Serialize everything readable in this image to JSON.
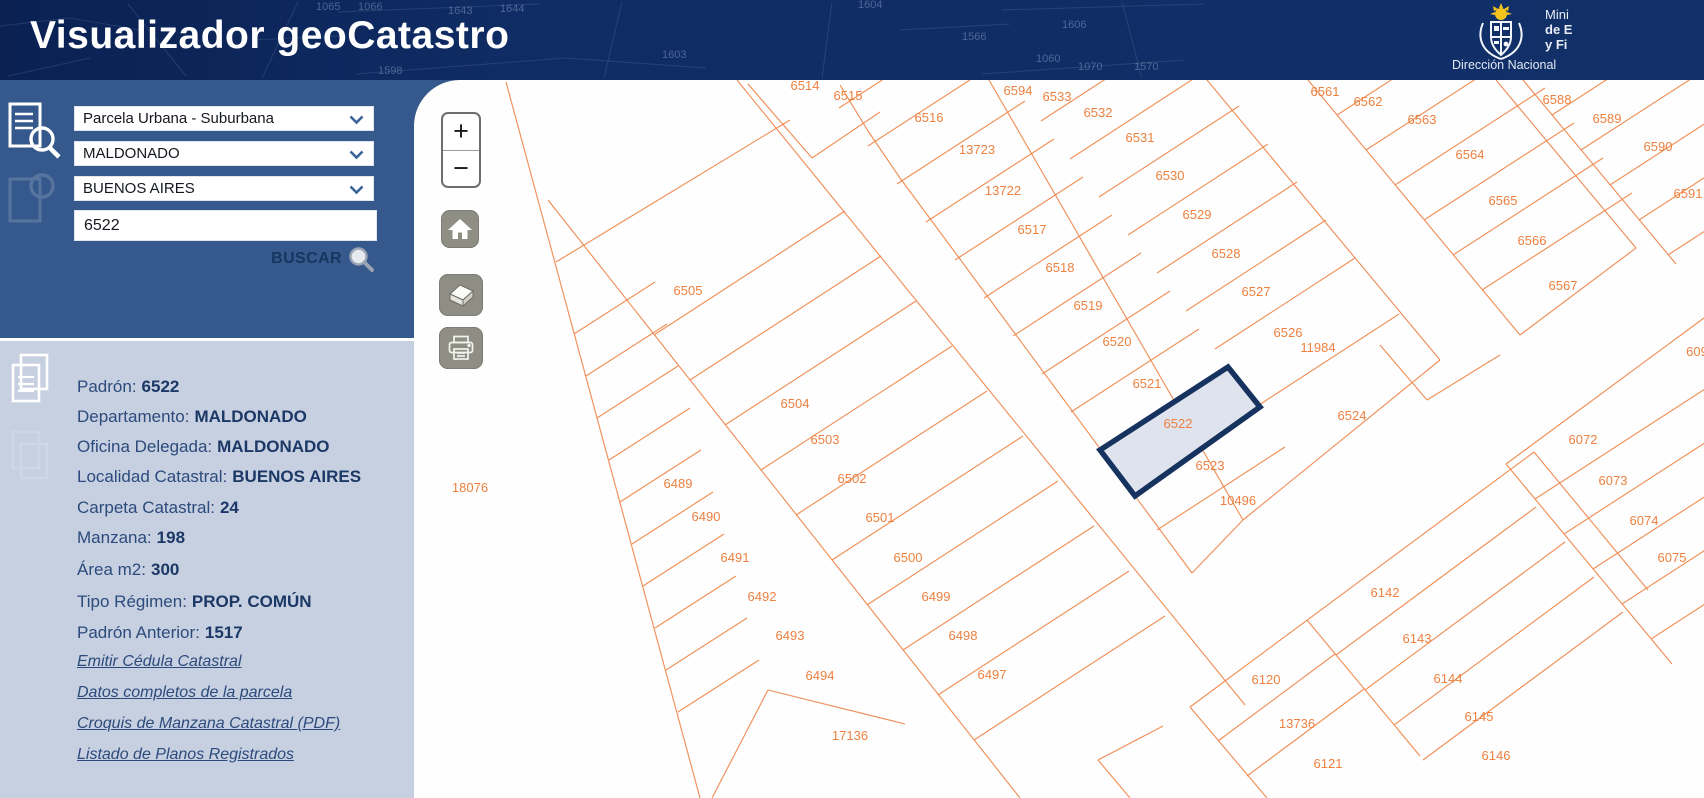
{
  "colors": {
    "header_bg": "#0f2c64",
    "search_panel_bg": "#35598c",
    "info_panel_bg": "#c6d0e0",
    "map_line": "#ef8a50",
    "map_label": "#ed8140",
    "selected_stroke": "#16335f",
    "selected_fill": "#dfe3ee",
    "link_color": "#2c4a7c"
  },
  "header": {
    "title": "Visualizador geoCatastro",
    "org_line1": "Mini",
    "org_line2": "de E",
    "org_line3": "y Fi",
    "org_sub": "Dirección Nacional",
    "sketch": {
      "segments": [
        [
          0,
          26,
          70,
          18
        ],
        [
          70,
          18,
          140,
          30
        ],
        [
          8,
          76,
          90,
          58
        ],
        [
          128,
          4,
          186,
          76
        ],
        [
          298,
          2,
          262,
          78
        ],
        [
          338,
          12,
          540,
          4
        ],
        [
          356,
          74,
          566,
          58
        ],
        [
          566,
          58,
          706,
          68
        ],
        [
          622,
          2,
          604,
          78
        ],
        [
          832,
          2,
          822,
          78
        ],
        [
          1002,
          10,
          1204,
          4
        ],
        [
          982,
          74,
          1184,
          60
        ],
        [
          1122,
          2,
          1142,
          78
        ],
        [
          250,
          40,
          340,
          36
        ],
        [
          900,
          30,
          1010,
          24
        ]
      ],
      "numbers": [
        [
          "1643",
          448,
          14
        ],
        [
          "1644",
          500,
          12
        ],
        [
          "1598",
          378,
          74
        ],
        [
          "1603",
          662,
          58
        ],
        [
          "1604",
          858,
          8
        ],
        [
          "1606",
          1062,
          28
        ],
        [
          "1060",
          1036,
          62
        ],
        [
          "1070",
          1078,
          70
        ],
        [
          "1570",
          1134,
          70
        ],
        [
          "1065",
          316,
          10
        ],
        [
          "1066",
          358,
          10
        ],
        [
          "1566",
          962,
          40
        ]
      ]
    }
  },
  "search_panel": {
    "selects": [
      {
        "value": "Parcela Urbana - Suburbana"
      },
      {
        "value": "MALDONADO"
      },
      {
        "value": "BUENOS AIRES"
      }
    ],
    "input_value": "6522",
    "button_label": "BUSCAR"
  },
  "info_panel": {
    "fields": [
      {
        "label": "Padrón:",
        "value": "6522"
      },
      {
        "label": "Departamento:",
        "value": "MALDONADO"
      },
      {
        "label": "Oficina Delegada:",
        "value": "MALDONADO"
      },
      {
        "label": "Localidad Catastral:",
        "value": "BUENOS AIRES"
      },
      {
        "label": "Carpeta Catastral:",
        "value": "24"
      },
      {
        "label": "Manzana:",
        "value": "198"
      },
      {
        "label": "Área m2:",
        "value": "300"
      },
      {
        "label": "Tipo Régimen:",
        "value": "PROP. COMÚN"
      },
      {
        "label": "Padrón Anterior:",
        "value": "1517"
      }
    ],
    "links": [
      "Emitir Cédula Catastral",
      "Datos completos de la parcela",
      "Croquis de Manzana Catastral (PDF)",
      "Listado de Planos Registrados"
    ]
  },
  "map": {
    "origin": [
      414,
      80
    ],
    "controls": {
      "zoom_in_label": "+",
      "zoom_out_label": "−"
    },
    "selected_parcel": {
      "id": "6522",
      "label_pos": [
        1178,
        428
      ],
      "points": [
        [
          1100,
          450
        ],
        [
          1228,
          367
        ],
        [
          1260,
          407
        ],
        [
          1135,
          496
        ]
      ]
    },
    "labels": [
      [
        "18076",
        470,
        492
      ],
      [
        "17136",
        850,
        740
      ],
      [
        "6514",
        805,
        90
      ],
      [
        "6515",
        848,
        100
      ],
      [
        "6516",
        929,
        122
      ],
      [
        "13723",
        977,
        154
      ],
      [
        "13722",
        1003,
        195
      ],
      [
        "6517",
        1032,
        234
      ],
      [
        "6518",
        1060,
        272
      ],
      [
        "6519",
        1088,
        310
      ],
      [
        "6520",
        1117,
        346
      ],
      [
        "6521",
        1147,
        388
      ],
      [
        "6523",
        1210,
        470
      ],
      [
        "10496",
        1238,
        505
      ],
      [
        "6594",
        1018,
        95
      ],
      [
        "6533",
        1057,
        101
      ],
      [
        "6532",
        1098,
        117
      ],
      [
        "6531",
        1140,
        142
      ],
      [
        "6530",
        1170,
        180
      ],
      [
        "6529",
        1197,
        219
      ],
      [
        "6528",
        1226,
        258
      ],
      [
        "6527",
        1256,
        296
      ],
      [
        "6526",
        1288,
        337
      ],
      [
        "11984",
        1318,
        352
      ],
      [
        "6524",
        1352,
        420
      ],
      [
        "6505",
        688,
        295
      ],
      [
        "6504",
        795,
        408
      ],
      [
        "6503",
        825,
        444
      ],
      [
        "6502",
        852,
        483
      ],
      [
        "6501",
        880,
        522
      ],
      [
        "6500",
        908,
        562
      ],
      [
        "6499",
        936,
        601
      ],
      [
        "6498",
        963,
        640
      ],
      [
        "6497",
        992,
        679
      ],
      [
        "6489",
        678,
        488
      ],
      [
        "6490",
        706,
        521
      ],
      [
        "6491",
        735,
        562
      ],
      [
        "6492",
        762,
        601
      ],
      [
        "6493",
        790,
        640
      ],
      [
        "6494",
        820,
        680
      ],
      [
        "6561",
        1325,
        96
      ],
      [
        "6562",
        1368,
        106
      ],
      [
        "6563",
        1422,
        124
      ],
      [
        "6564",
        1470,
        159
      ],
      [
        "6565",
        1503,
        205
      ],
      [
        "6566",
        1532,
        245
      ],
      [
        "6567",
        1563,
        290
      ],
      [
        "6588",
        1557,
        104
      ],
      [
        "6589",
        1607,
        123
      ],
      [
        "6590",
        1658,
        151
      ],
      [
        "6591",
        1688,
        198
      ],
      [
        "609",
        1697,
        356
      ],
      [
        "6072",
        1583,
        444
      ],
      [
        "6073",
        1613,
        485
      ],
      [
        "6074",
        1644,
        525
      ],
      [
        "6075",
        1672,
        562
      ],
      [
        "6142",
        1385,
        597
      ],
      [
        "6143",
        1417,
        643
      ],
      [
        "6144",
        1448,
        683
      ],
      [
        "6145",
        1479,
        721
      ],
      [
        "6146",
        1496,
        760
      ],
      [
        "6120",
        1266,
        684
      ],
      [
        "13736",
        1297,
        728
      ],
      [
        "6121",
        1328,
        768
      ]
    ],
    "segments": [
      [
        506,
        82,
        700,
        798
      ],
      [
        712,
        798,
        768,
        690
      ],
      [
        768,
        690,
        905,
        724
      ],
      [
        556,
        262,
        790,
        120
      ],
      [
        737,
        80,
        1245,
        705
      ],
      [
        548,
        200,
        1020,
        798
      ],
      [
        654,
        335,
        845,
        211
      ],
      [
        690,
        380,
        881,
        256
      ],
      [
        725,
        425,
        916,
        301
      ],
      [
        761,
        470,
        952,
        346
      ],
      [
        796,
        515,
        987,
        391
      ],
      [
        832,
        560,
        1023,
        436
      ],
      [
        867,
        605,
        1058,
        481
      ],
      [
        903,
        650,
        1094,
        526
      ],
      [
        938,
        695,
        1129,
        571
      ],
      [
        974,
        740,
        1165,
        616
      ],
      [
        574,
        334,
        655,
        282
      ],
      [
        586,
        376,
        667,
        324
      ],
      [
        597,
        418,
        678,
        366
      ],
      [
        609,
        460,
        690,
        408
      ],
      [
        620,
        502,
        701,
        450
      ],
      [
        632,
        544,
        713,
        492
      ],
      [
        643,
        586,
        724,
        534
      ],
      [
        655,
        628,
        736,
        576
      ],
      [
        666,
        670,
        747,
        618
      ],
      [
        678,
        712,
        759,
        660
      ],
      [
        748,
        84,
        812,
        158
      ],
      [
        812,
        158,
        880,
        112
      ],
      [
        840,
        85,
        868,
        131
      ],
      [
        868,
        131,
        900,
        178
      ],
      [
        900,
        178,
        1192,
        573
      ],
      [
        989,
        80,
        1243,
        520
      ],
      [
        1207,
        80,
        1440,
        360
      ],
      [
        1192,
        573,
        1243,
        520
      ],
      [
        1243,
        520,
        1440,
        360
      ],
      [
        1071,
        412,
        1199,
        329
      ],
      [
        1042,
        374,
        1170,
        291
      ],
      [
        1013,
        336,
        1141,
        253
      ],
      [
        984,
        298,
        1112,
        215
      ],
      [
        955,
        260,
        1083,
        177
      ],
      [
        926,
        222,
        1054,
        139
      ],
      [
        897,
        184,
        1025,
        101
      ],
      [
        868,
        146,
        996,
        63
      ],
      [
        839,
        108,
        967,
        25
      ],
      [
        1157,
        530,
        1285,
        447
      ],
      [
        1215,
        349,
        1355,
        258
      ],
      [
        1186,
        311,
        1326,
        220
      ],
      [
        1157,
        273,
        1297,
        182
      ],
      [
        1128,
        235,
        1268,
        144
      ],
      [
        1099,
        197,
        1239,
        106
      ],
      [
        1070,
        159,
        1210,
        68
      ],
      [
        1041,
        121,
        1181,
        30
      ],
      [
        1259,
        405,
        1399,
        314
      ],
      [
        1308,
        80,
        1520,
        335
      ],
      [
        1337,
        115,
        1487,
        18
      ],
      [
        1366,
        150,
        1516,
        53
      ],
      [
        1395,
        185,
        1545,
        88
      ],
      [
        1424,
        220,
        1574,
        123
      ],
      [
        1453,
        255,
        1603,
        158
      ],
      [
        1482,
        290,
        1632,
        193
      ],
      [
        1496,
        80,
        1636,
        248
      ],
      [
        1520,
        335,
        1636,
        248
      ],
      [
        1523,
        80,
        1676,
        264
      ],
      [
        1552,
        115,
        1702,
        18
      ],
      [
        1581,
        150,
        1731,
        53
      ],
      [
        1610,
        185,
        1760,
        88
      ],
      [
        1639,
        220,
        1789,
        123
      ],
      [
        1668,
        255,
        1818,
        158
      ],
      [
        1380,
        345,
        1427,
        400
      ],
      [
        1427,
        400,
        1500,
        355
      ],
      [
        1506,
        464,
        1704,
        318
      ],
      [
        1506,
        464,
        1672,
        664
      ],
      [
        1535,
        499,
        1705,
        389
      ],
      [
        1564,
        534,
        1734,
        424
      ],
      [
        1593,
        569,
        1763,
        459
      ],
      [
        1622,
        604,
        1792,
        494
      ],
      [
        1651,
        639,
        1821,
        529
      ],
      [
        1190,
        707,
        1534,
        452
      ],
      [
        1190,
        707,
        1267,
        798
      ],
      [
        1307,
        620,
        1420,
        756
      ],
      [
        1218,
        741,
        1335,
        654
      ],
      [
        1247,
        776,
        1364,
        689
      ],
      [
        1336,
        655,
        1536,
        507
      ],
      [
        1365,
        690,
        1565,
        542
      ],
      [
        1394,
        725,
        1594,
        577
      ],
      [
        1423,
        760,
        1623,
        612
      ],
      [
        1534,
        452,
        1648,
        590
      ],
      [
        1098,
        760,
        1130,
        798
      ],
      [
        1098,
        760,
        1163,
        726
      ]
    ]
  }
}
